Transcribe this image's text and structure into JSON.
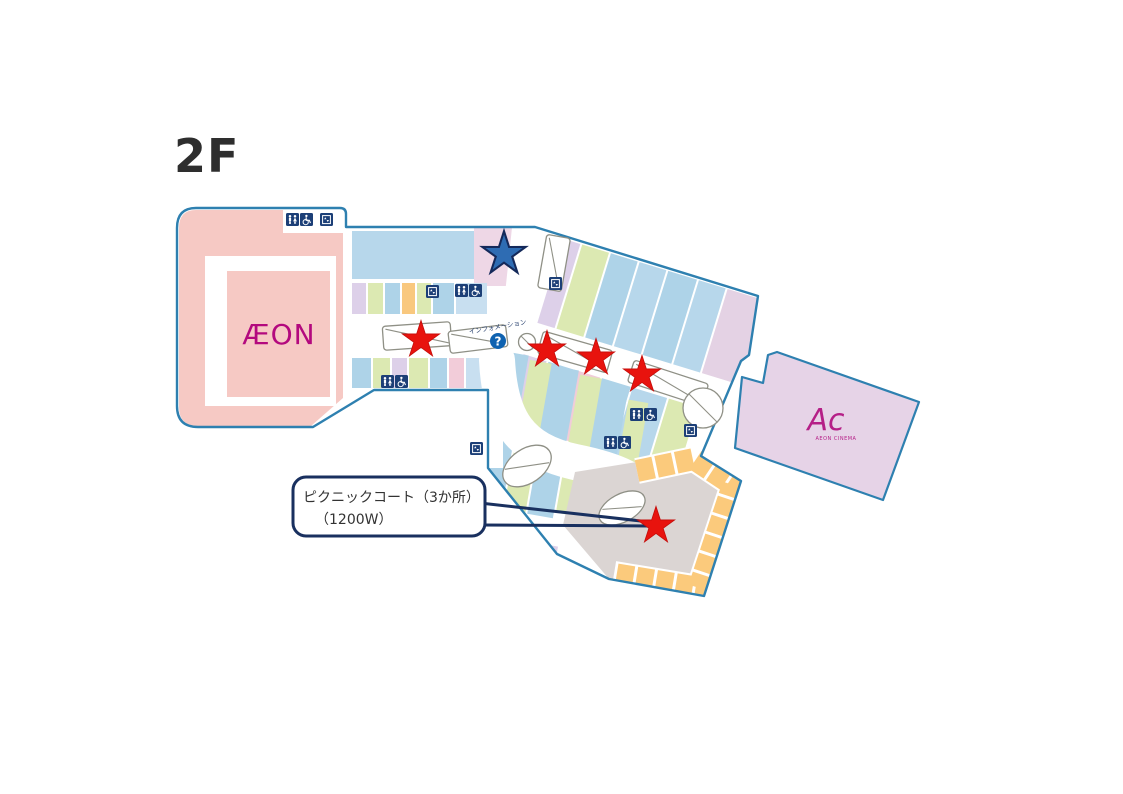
{
  "title": "2F",
  "map": {
    "aeon": {
      "logo": "ÆON"
    },
    "cinema": {
      "logo": "Ac",
      "caption": "AEON CINEMA"
    },
    "information": {
      "label": "インフォメーション",
      "symbol": "?"
    },
    "callout": {
      "line1": "ピクニックコート（3か所）",
      "line2": "（1200W）"
    },
    "markers": {
      "red_star_count": 5,
      "blue_star_count": 1
    },
    "facility_icons": [
      "restroom-icon",
      "wheelchair-icon",
      "elevator-icon",
      "escalator-symbol",
      "information-icon"
    ],
    "colors": {
      "outline": "#2e80b0",
      "aeon_pink": "#f6c9c4",
      "shop_blue": "#aed3e8",
      "shop_blue_light": "#c8dff0",
      "shop_green": "#dce9b2",
      "shop_lavender": "#ddd0e9",
      "shop_orange": "#f9c87e",
      "shop_pink": "#f2ccd9",
      "star_pink": "#eed7e6",
      "cinema_purple": "#e6d3e7",
      "foodcourt_gray": "#dbd5d3",
      "foodcourt_orange": "#fbca7c",
      "navy": "#19305f",
      "red_star": "#e8130e",
      "blue_star": "#2e6cb3",
      "info_blue": "#0f62b0",
      "logo_magenta": "#b3097e"
    }
  }
}
